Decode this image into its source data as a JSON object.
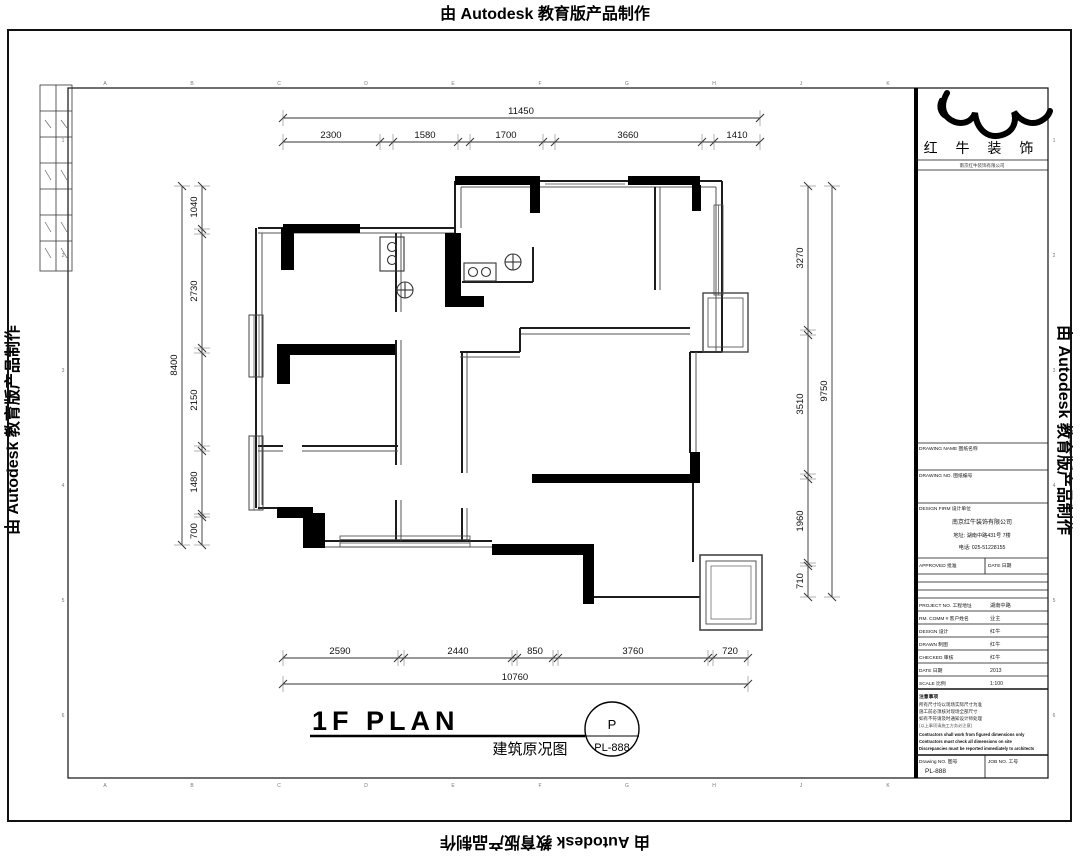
{
  "watermark": {
    "text": "由 Autodesk 教育版产品制作"
  },
  "title": {
    "main": "1F PLAN",
    "subtitle": "建筑原况图",
    "stamp_letter": "P",
    "stamp_number": "PL-888"
  },
  "dims": {
    "top": {
      "overall": "11450",
      "segments": [
        "2300",
        "1580",
        "1700",
        "3660",
        "1410"
      ]
    },
    "left": {
      "overall": "8400",
      "segments": [
        "1040",
        "2730",
        "2150",
        "1480",
        "700"
      ]
    },
    "right": {
      "overall": "9750",
      "segments": [
        "3270",
        "3510",
        "1960",
        "710"
      ]
    },
    "bottom": {
      "overall": "10760",
      "segments": [
        "2590",
        "2440",
        "850",
        "3760",
        "720"
      ]
    }
  },
  "frame": {
    "letters": [
      "A",
      "B",
      "C",
      "D",
      "E",
      "F",
      "G",
      "H",
      "J",
      "K"
    ],
    "side_numbers": [
      "1",
      "2",
      "3",
      "4",
      "5",
      "6"
    ]
  },
  "titleblock": {
    "brand": "红 牛 装 饰",
    "brand_sub": "南京红牛装饰有限公司",
    "rows": {
      "drawing_name_label": "DRAWING NAME 图纸名称",
      "drawing_no2_label": "DRAWING NO. 图纸编号",
      "firm_label": "DESIGN FIRM 设计单位",
      "company_line1": "南京红牛装饰有限公司",
      "company_line2": "地址: 湖南中路431号 7楼",
      "company_line3": "电话: 025-51228155",
      "approved_label": "APPROVED 批准",
      "date2_label": "DATE 日期",
      "project_label": "PROJECT NO. 工程地址",
      "project_value": "湖南中路",
      "room_label": "RM. COMM # 客户姓名",
      "room_value": "业主",
      "design_label": "DESIGN 设计",
      "design_value": "红牛",
      "drawn_label": "DRAWN 制图",
      "drawn_value": "红牛",
      "checked_label": "CHECKED 审核",
      "checked_value": "红牛",
      "date_label": "DATE 日期",
      "date_value": "2013",
      "scale_label": "SCALE 比例",
      "scale_value": "1:100",
      "notes_title": "注意事项",
      "note_zh1": "所有尺寸均以现场实际尺寸为准",
      "note_zh2": "施工前必须核对现场全部尺寸",
      "note_zh3": "如有不符请及时通知设计师处理",
      "note_zh4": "(以上事项请施工方务必注意)",
      "note_en1": "Contractors shall work from figured dimensions only",
      "note_en2": "Contractors must check all dimensions on site",
      "note_en3": "Discrepancies must be reported immediately to architects",
      "drawingno_label": "Drawing NO. 图号",
      "drawingno_value": "PL-888",
      "jobno_label": "JOB NO. 工号",
      "jobno_value": ""
    }
  }
}
